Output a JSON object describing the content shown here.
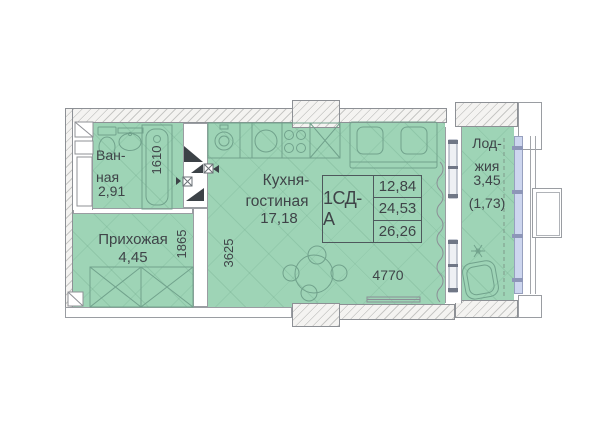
{
  "unit_table": {
    "label": "1СД-А",
    "rows": [
      "12,84",
      "24,53",
      "26,26"
    ]
  },
  "rooms": {
    "bathroom": {
      "line1": "Ван-",
      "line2": "ная",
      "area": "2,91"
    },
    "hallway": {
      "name": "Прихожая",
      "area": "4,45"
    },
    "kitchen": {
      "line1": "Кухня-",
      "line2": "гостиная",
      "area": "17,18"
    },
    "loggia": {
      "line1": "Лод-",
      "line2": "жия",
      "area": "3,45",
      "area_reduced": "(1,73)"
    }
  },
  "dimensions": {
    "bath_width_mm": "1610",
    "hall_width_mm": "1865",
    "kitchen_width_mm": "3625",
    "kitchen_length_mm": "4770"
  },
  "colors": {
    "floor_green": "#9ed4b6",
    "window_blue": "#cdd6ef",
    "wall_fill": "#f4f3f1",
    "line_dark": "#3f4448"
  }
}
